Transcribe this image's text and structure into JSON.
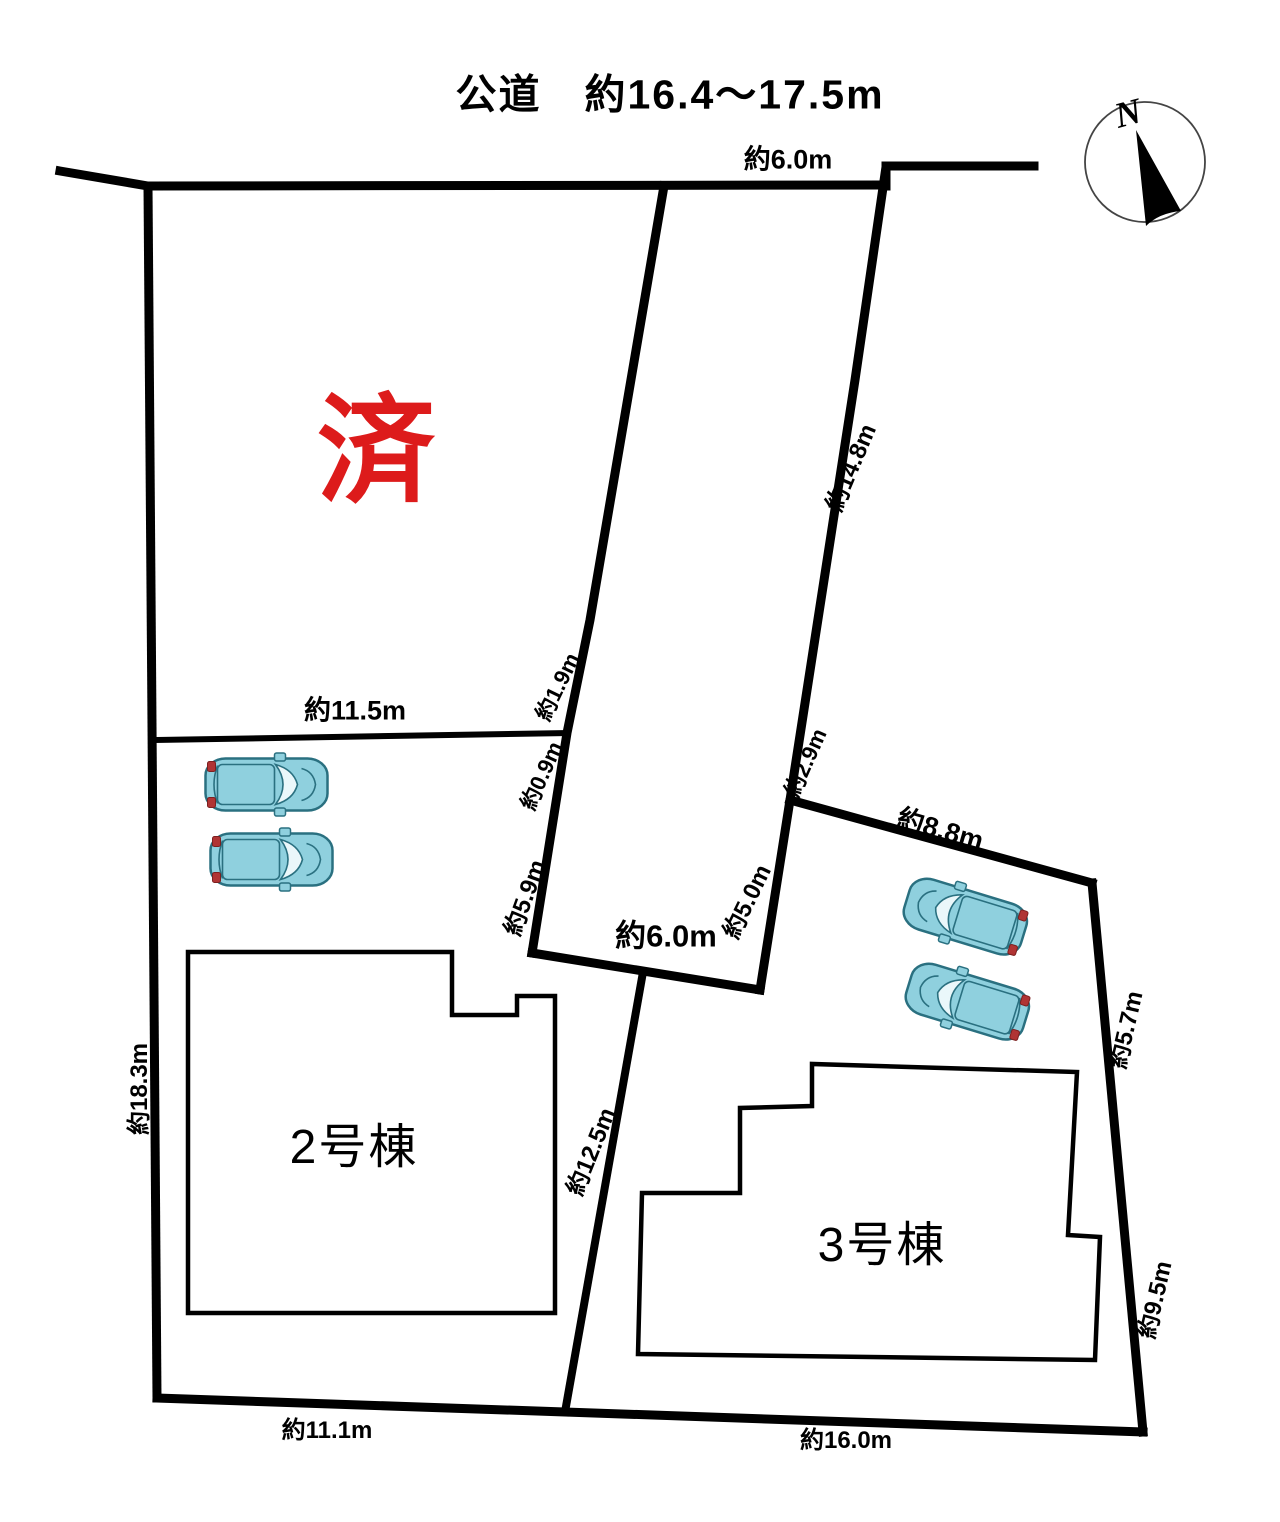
{
  "title": {
    "text": "公道　約16.4〜17.5m"
  },
  "compass": {
    "north": "N"
  },
  "colors": {
    "line": "#000000",
    "sold_red": "#dd1b1b",
    "car_body": "#8fd0de",
    "car_outline": "#2a7080",
    "car_glass": "#eaf7fa",
    "car_light": "#b03434"
  },
  "plots": {
    "sold_lot": {
      "status_label": "済"
    },
    "lot2": {
      "building_label": "2号棟"
    },
    "lot3": {
      "building_label": "3号棟"
    }
  },
  "measurements": {
    "road_top": "約6.0m",
    "lot1_inner_width": "約11.5m",
    "strip_left_a": "約1.9m",
    "strip_left_b": "約0.9m",
    "strip_left_c": "約5.9m",
    "strip_bottom": "約6.0m",
    "strip_right_a": "約14.8m",
    "strip_right_b": "約2.9m",
    "strip_right_c": "約5.0m",
    "lot3_top": "約8.8m",
    "lot3_right_upper": "約5.7m",
    "lot3_right_lower": "約9.5m",
    "lot2_left": "約18.3m",
    "lot2_right": "約12.5m",
    "lot2_bottom": "約11.1m",
    "lot3_bottom": "約16.0m"
  }
}
